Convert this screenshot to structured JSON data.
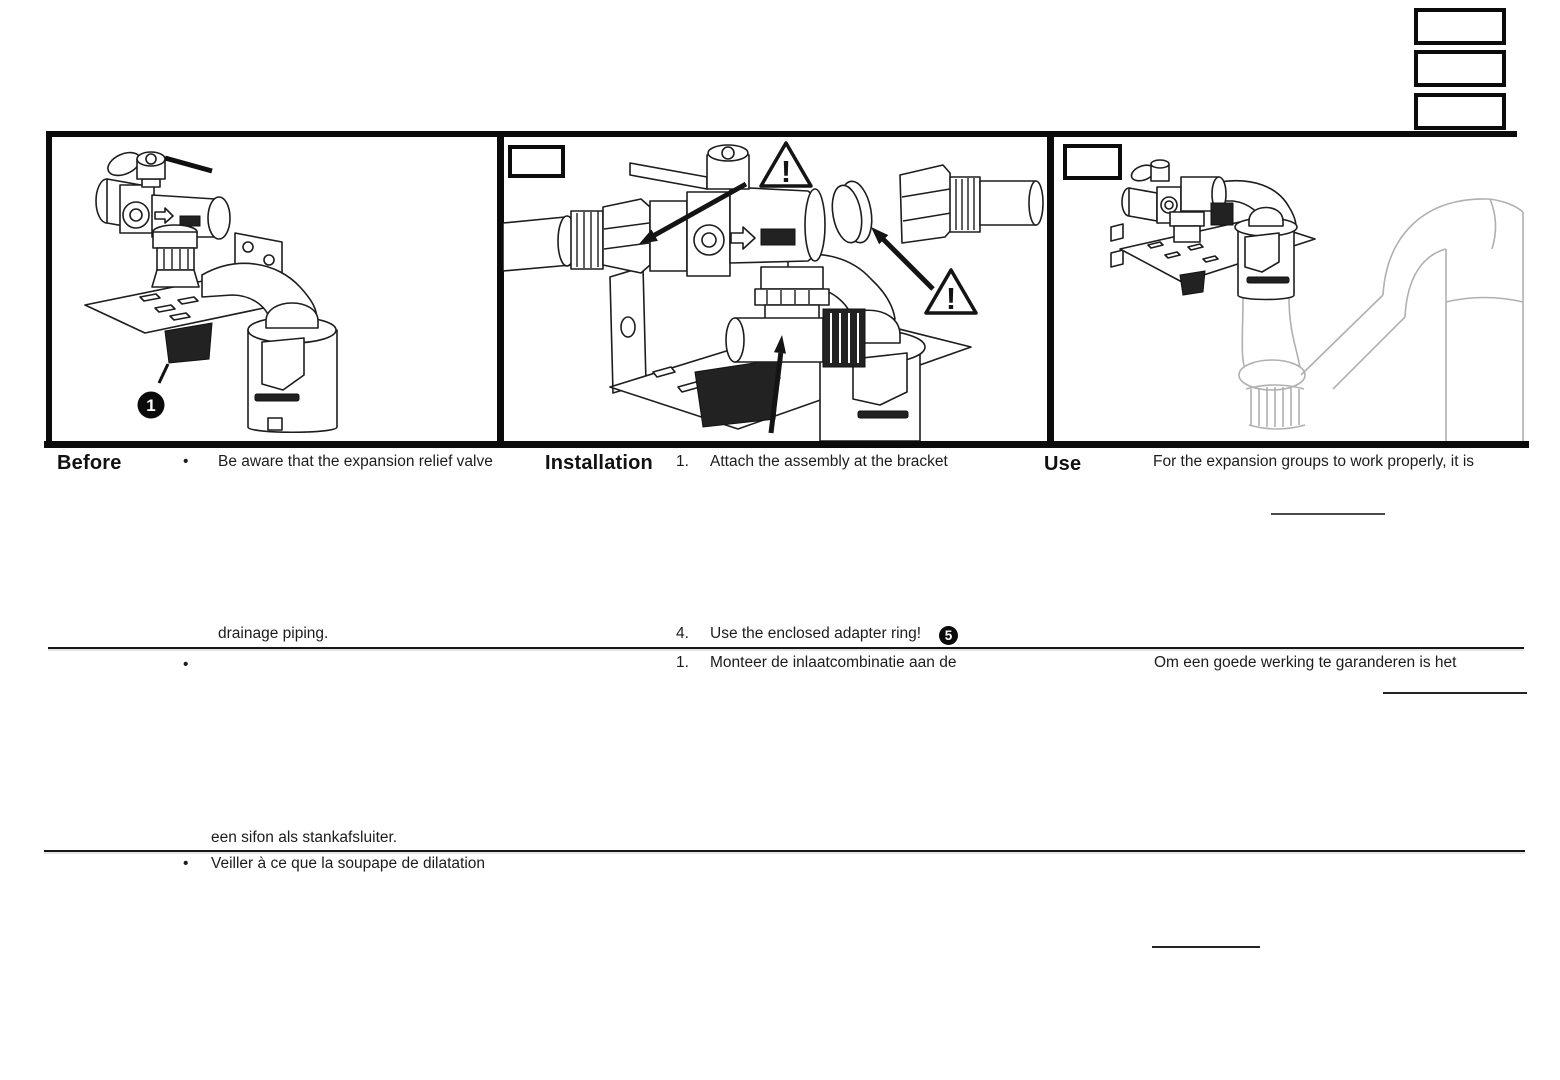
{
  "colors": {
    "ink": "#1c1c1c",
    "frame": "#0b0b0b",
    "gray_pipe": "#b0b0b0"
  },
  "top_right_boxes": [
    {
      "label": ""
    },
    {
      "label": ""
    },
    {
      "label": ""
    }
  ],
  "figures": {
    "before": {
      "callout": "1"
    },
    "installation": {
      "box_label": "",
      "warning": "!"
    },
    "use": {
      "box_label": ""
    }
  },
  "columns": {
    "before": {
      "heading": "Before",
      "bullets": [
        {
          "marker": "•",
          "line1": "Be aware that the expansion relief valve",
          "last_line": "drainage piping."
        },
        {
          "marker": "•",
          "line1": "",
          "last_line": "een sifon als stankafsluiter."
        },
        {
          "marker": "•",
          "line1": "Veiller à ce que la soupape de dilatation"
        }
      ]
    },
    "installation": {
      "heading": "Installation",
      "steps": [
        {
          "num": "1.",
          "text": "Attach the assembly at the bracket"
        },
        {
          "num": "4.",
          "text": "Use the enclosed adapter ring!",
          "callout": "5"
        },
        {
          "num": "1.",
          "text": "Monteer de inlaatcombinatie aan de"
        }
      ]
    },
    "use": {
      "heading": "Use",
      "line_en": "For the expansion groups to work properly, it is",
      "line_nl": "Om een goede werking te garanderen is het"
    }
  }
}
